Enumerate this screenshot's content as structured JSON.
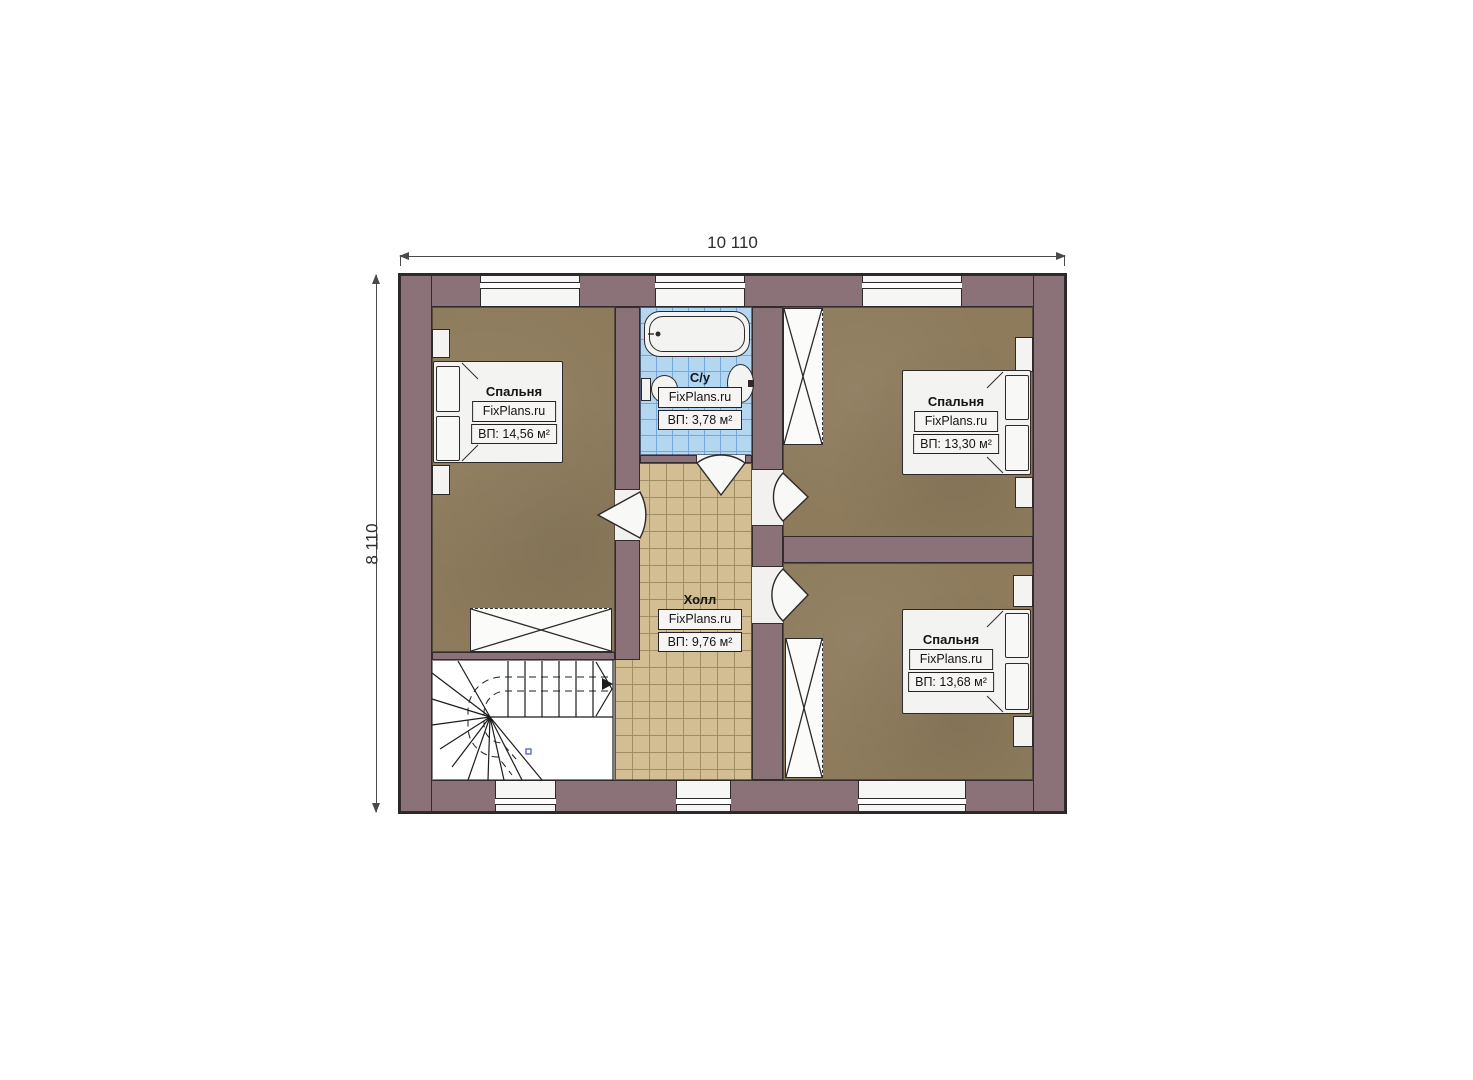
{
  "dimensions": {
    "width_label": "10 110",
    "height_label": "8 110"
  },
  "rooms": {
    "bedroom_left": {
      "name": "Спальня",
      "brand": "FixPlans.ru",
      "area": "ВП: 14,56 м²"
    },
    "bathroom": {
      "name": "С/у",
      "brand": "FixPlans.ru",
      "area": "ВП: 3,78 м²"
    },
    "hall": {
      "name": "Холл",
      "brand": "FixPlans.ru",
      "area": "ВП: 9,76 м²"
    },
    "bedroom_top_right": {
      "name": "Спальня",
      "brand": "FixPlans.ru",
      "area": "ВП: 13,30 м²"
    },
    "bedroom_bottom_right": {
      "name": "Спальня",
      "brand": "FixPlans.ru",
      "area": "ВП: 13,68 м²"
    }
  },
  "colors": {
    "wall": "#8b7278",
    "bedroom_floor": "#8d7b5c",
    "hall_tile": "#d3be93",
    "bath_tile": "#b3d6f1",
    "outline": "#2c2729",
    "dim_line": "#4a4a4a",
    "stair_marker_blue": "#4150c8"
  }
}
